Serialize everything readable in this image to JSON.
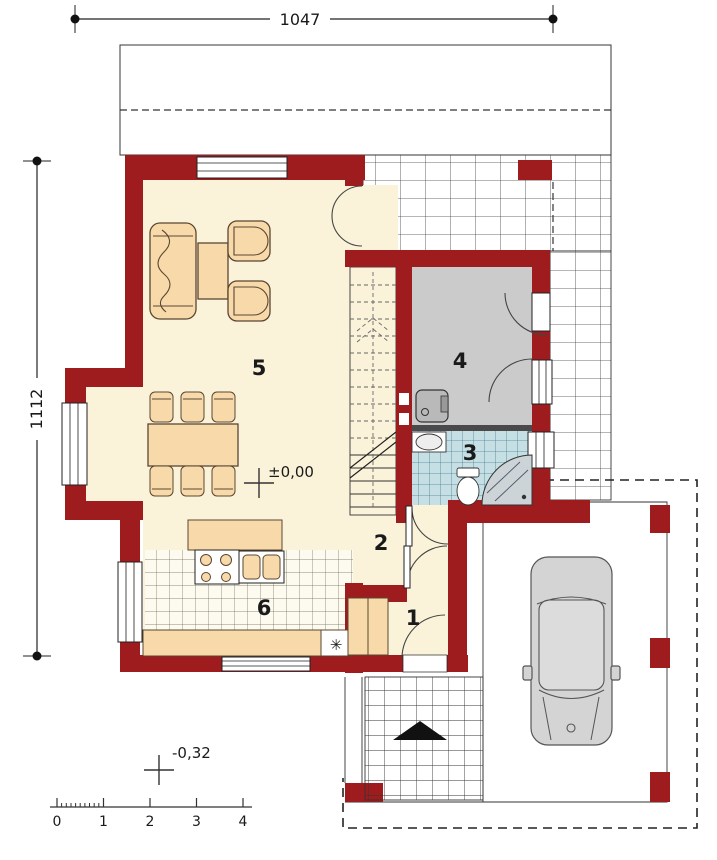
{
  "plan": {
    "dimensions": {
      "width_label": "1047",
      "height_label": "1112"
    },
    "levels": {
      "interior": "±0,00",
      "exterior": "-0,32"
    },
    "rooms": [
      {
        "number": "1"
      },
      {
        "number": "2"
      },
      {
        "number": "3"
      },
      {
        "number": "4"
      },
      {
        "number": "5"
      },
      {
        "number": "6"
      }
    ],
    "scale_bar": {
      "labels": [
        "0",
        "1",
        "2",
        "3",
        "4"
      ]
    },
    "symbols": {
      "fireplace": "✳"
    },
    "colors": {
      "wall": "#9e1b1e",
      "floor": "#faf3da",
      "tile_floor": "#fdfaf0",
      "room4_floor": "#cbcbcb",
      "bath_floor": "#c5dfe4",
      "furniture": "#f8d9a9",
      "car": "#d4d4d4",
      "line": "#1a1a1a"
    }
  }
}
